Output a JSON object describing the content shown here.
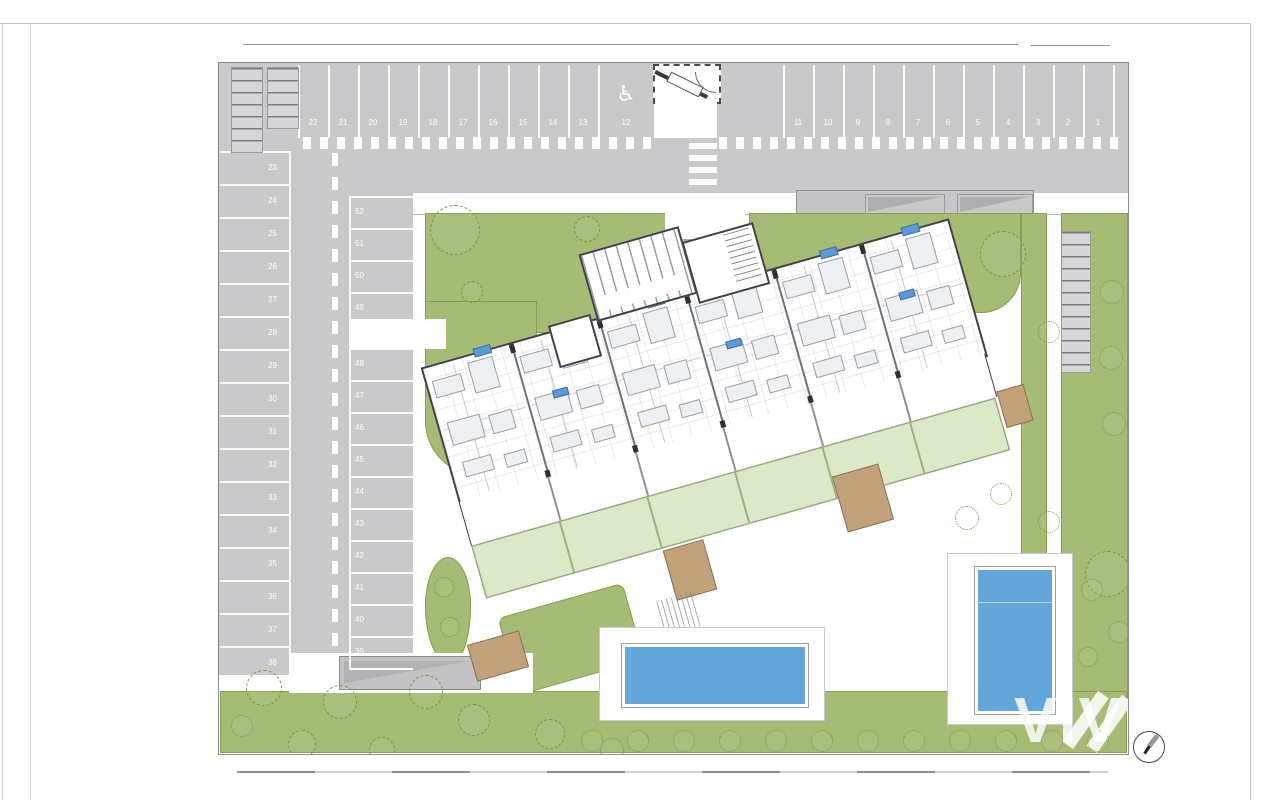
{
  "plan": {
    "watermark": "VIV",
    "accessible_icon": "♿",
    "parking": {
      "top_left": [
        "22",
        "21",
        "20",
        "19",
        "18",
        "17",
        "16",
        "15",
        "14",
        "13"
      ],
      "accessible": "12",
      "top_right": [
        "11",
        "10",
        "9",
        "8",
        "7",
        "6",
        "5",
        "4",
        "3",
        "2",
        "1"
      ],
      "left_col": [
        "23",
        "24",
        "25",
        "26",
        "27",
        "28",
        "29",
        "30",
        "31",
        "32",
        "33",
        "34",
        "35",
        "36",
        "37",
        "38"
      ],
      "mid_upper": [
        "52",
        "51",
        "50",
        "49"
      ],
      "mid_lower": [
        "48",
        "47",
        "46",
        "45",
        "44",
        "43",
        "42",
        "41",
        "40",
        "39"
      ]
    },
    "colors": {
      "asphalt": "#c9c9cb",
      "asphalt_dark": "#bfbfc1",
      "grass": "#a6bc74",
      "grass_line": "#87a050",
      "tree_line": "#7a974a",
      "pool": "#64a5da",
      "garden": "#dce9c9",
      "wood": "#c0a179",
      "wood_line": "#8a7352",
      "marker": "#5b9bd5",
      "wall": "#3f4248"
    }
  }
}
